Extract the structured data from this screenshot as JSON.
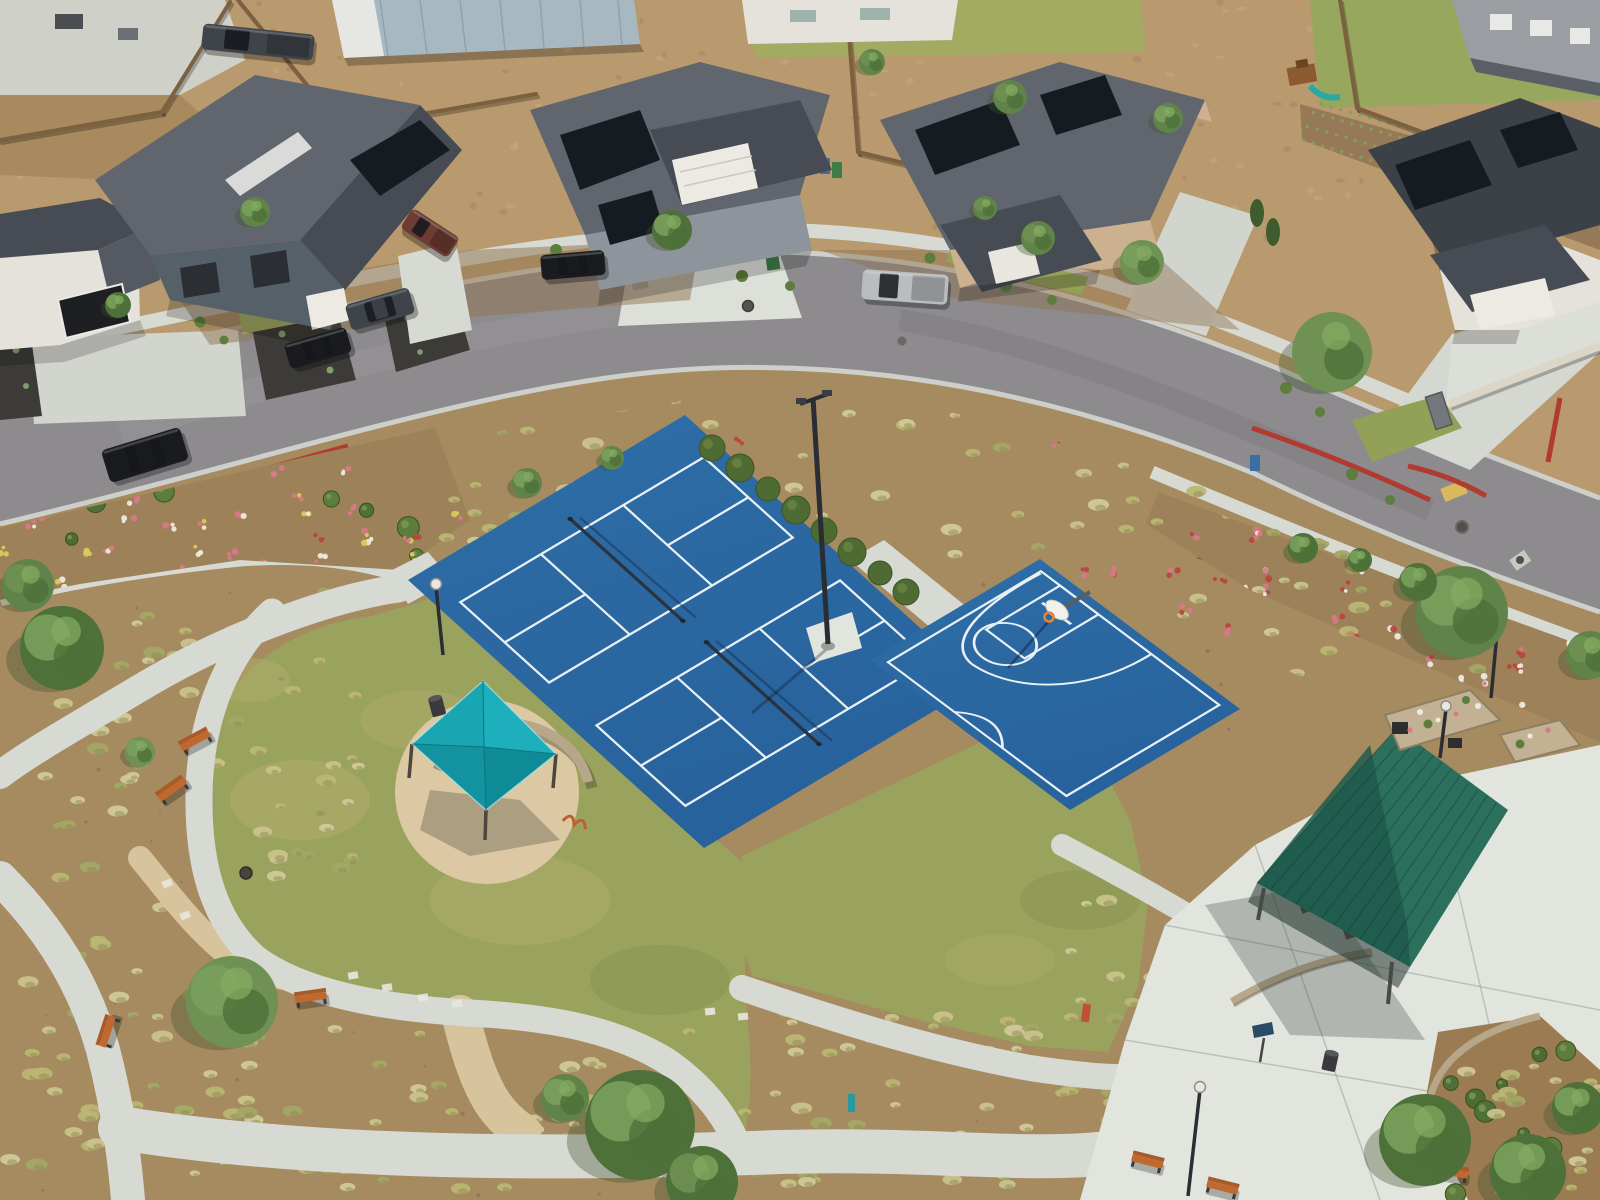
{
  "scene": {
    "title": "Aerial drone view of a community park with sport courts in a new residential neighborhood",
    "features": {
      "pickleball_courts": 2,
      "basketball_half_courts": 1,
      "shade_sail": "teal square canopy over seating area",
      "picnic_pavilion": "green metal gable roof",
      "benches": 7,
      "light_poles": 5,
      "vehicles": 7
    },
    "colors": {
      "court_blue": "#2e6da7",
      "court_blue_dark": "#27619b",
      "court_line": "#e9f1f5",
      "lawn": "#9aa35e",
      "lawn_light": "#b5b172",
      "lawn_dark": "#7e8c4a",
      "concrete": "#d7d9d3",
      "concrete_bright": "#e2e4de",
      "dg": "#d8c49c",
      "dg_circle": "#dcc9a4",
      "street": "#8d8b8e",
      "curb": "#cdd0ca",
      "red_curb": "#b23a30",
      "mulch": "#a68a60",
      "mulch_dark": "#8d7150",
      "bed_mulch": "#9d8158",
      "dirt": "#b89a6e",
      "dirt_light": "#c9ad80",
      "fence": "#7d6040",
      "wall_light": "#dbd6c7",
      "stone": "#b7a78a",
      "canopy_ne": "#1db0bc",
      "canopy_se": "#0f8b97",
      "canopy_sw": "#12939f",
      "canopy_nw": "#19a5b1",
      "pavilion_roof": "#2b6f5d",
      "pavilion_roof_dark": "#1e5a4b",
      "roof_gray": "#61666e",
      "roof_dark": "#474c54",
      "roof_darker": "#3c4148",
      "solar": "#161b22",
      "white_wall": "#e4e2da",
      "tan_wall": "#cbb18f",
      "gray_wall": "#566069",
      "trim": "#eceae2",
      "tree1": "#5f8348",
      "tree2": "#4d7139",
      "tree3": "#6f9153",
      "shrub": "#4e6b33",
      "tuftA": "#bab674",
      "tuftB": "#c9c38a",
      "tuftC": "#a3a865",
      "tuftD": "#d0c998",
      "bench_seat": "#c0692f",
      "bench_back": "#a85a28",
      "bench_frame": "#333a42",
      "black_car": "#1a1b1e",
      "gray_car": "#3f444b",
      "silver_car": "#b9bdc0",
      "maroon_car": "#6e3c34",
      "hoop_orange": "#e8842f",
      "teal_fountain": "#2b9aa0",
      "red_fountain": "#c05038",
      "sign_blue": "#2b4a66",
      "yellow_ada": "#d9b95c",
      "black_mulch": "#3c3b38",
      "agave": "#7fa06a",
      "flower_pink": "#d9788a",
      "flower_red": "#b8473d",
      "flower_white": "#ece9df",
      "flower_yellow": "#d9c95e",
      "barn_roof": "#a7b8c1"
    },
    "trees": [
      [
        62,
        648,
        42
      ],
      [
        28,
        585,
        26
      ],
      [
        140,
        752,
        15
      ],
      [
        232,
        1002,
        46
      ],
      [
        640,
        1125,
        55
      ],
      [
        702,
        1182,
        36
      ],
      [
        565,
        1098,
        24
      ],
      [
        1425,
        1140,
        46
      ],
      [
        1528,
        1172,
        38
      ],
      [
        1578,
        1108,
        26
      ],
      [
        1462,
        612,
        46
      ],
      [
        1332,
        352,
        40
      ],
      [
        1590,
        655,
        24
      ],
      [
        672,
        230,
        20
      ],
      [
        1142,
        262,
        22
      ],
      [
        1038,
        238,
        17
      ],
      [
        527,
        483,
        15
      ],
      [
        612,
        458,
        12
      ],
      [
        1303,
        548,
        15
      ],
      [
        1418,
        582,
        19
      ],
      [
        1010,
        97,
        17
      ],
      [
        1168,
        118,
        15
      ],
      [
        872,
        62,
        13
      ],
      [
        255,
        212,
        15
      ],
      [
        118,
        305,
        13
      ],
      [
        985,
        208,
        12
      ],
      [
        1360,
        560,
        12
      ]
    ],
    "benches": [
      [
        196,
        742,
        -28
      ],
      [
        173,
        791,
        -35
      ],
      [
        311,
        999,
        -8
      ],
      [
        109,
        1032,
        -72
      ],
      [
        1147,
        1163,
        14
      ],
      [
        1222,
        1189,
        14
      ],
      [
        1452,
        1174,
        10
      ]
    ],
    "vehicles": [
      {
        "name": "black-suv",
        "x": 145,
        "y": 455,
        "w": 82,
        "h": 34,
        "angle": -17,
        "color": "black_car",
        "truck": false
      },
      {
        "name": "black-sedan",
        "x": 318,
        "y": 348,
        "w": 64,
        "h": 26,
        "angle": -16,
        "color": "black_car",
        "truck": false
      },
      {
        "name": "gray-suv",
        "x": 380,
        "y": 309,
        "w": 66,
        "h": 27,
        "angle": -16,
        "color": "gray_car",
        "truck": false
      },
      {
        "name": "black-sedan-2",
        "x": 573,
        "y": 265,
        "w": 64,
        "h": 25,
        "angle": -5,
        "color": "black_car",
        "truck": false
      },
      {
        "name": "silver-pickup",
        "x": 905,
        "y": 287,
        "w": 86,
        "h": 30,
        "angle": 4,
        "color": "silver_car",
        "truck": true
      },
      {
        "name": "maroon-pickup",
        "x": 430,
        "y": 233,
        "w": 56,
        "h": 24,
        "angle": 33,
        "color": "maroon_car",
        "truck": true
      },
      {
        "name": "work-truck",
        "x": 258,
        "y": 42,
        "w": 112,
        "h": 26,
        "angle": 6,
        "color": "gray_car",
        "truck": true
      }
    ],
    "scatter": [
      {
        "id": "dirt-top",
        "kind": "dirt",
        "bounds": [
          0,
          0,
          1600,
          240
        ],
        "count": 150
      },
      {
        "id": "park-dots",
        "kind": "mulchdots",
        "bounds": [
          0,
          560,
          1240,
          640
        ],
        "count": 90
      },
      {
        "id": "buffer",
        "kind": "tuft",
        "bounds": [
          260,
          400,
          1180,
          300
        ],
        "count": 120,
        "clip": "clipBuffer"
      },
      {
        "id": "buffer-fl",
        "kind": "flowers",
        "colors": [
          "flower_red",
          "flower_pink"
        ],
        "bounds": [
          300,
          430,
          1000,
          240
        ],
        "count": 26,
        "clip": "clipBuffer"
      },
      {
        "id": "bed-left",
        "kind": "flowers",
        "colors": [
          "flower_white",
          "flower_pink",
          "flower_yellow"
        ],
        "bounds": [
          0,
          470,
          460,
          120
        ],
        "count": 34,
        "clip": "clipBedLeft"
      },
      {
        "id": "bed-left-sh",
        "kind": "shrubs",
        "bounds": [
          0,
          470,
          460,
          120
        ],
        "count": 12,
        "clip": "clipBedLeft"
      },
      {
        "id": "bench-area",
        "kind": "tuft",
        "bounds": [
          40,
          610,
          320,
          270
        ],
        "count": 60
      },
      {
        "id": "sw-corner",
        "kind": "tuft",
        "bounds": [
          10,
          890,
          250,
          300
        ],
        "count": 55
      },
      {
        "id": "south-band",
        "kind": "tuft",
        "bounds": [
          240,
          1010,
          840,
          180
        ],
        "count": 110
      },
      {
        "id": "east-mulch",
        "kind": "tuft",
        "bounds": [
          1060,
          900,
          320,
          230
        ],
        "count": 48
      },
      {
        "id": "right-bed",
        "kind": "flowers",
        "colors": [
          "flower_pink",
          "flower_red",
          "flower_white"
        ],
        "bounds": [
          1180,
          500,
          420,
          250
        ],
        "count": 46,
        "clip": "clipBedRight"
      },
      {
        "id": "right-bed-t",
        "kind": "tuft",
        "bounds": [
          1180,
          500,
          420,
          250
        ],
        "count": 22,
        "clip": "clipBedRight"
      },
      {
        "id": "se-bed-sh",
        "kind": "shrubs",
        "bounds": [
          1440,
          1040,
          160,
          160
        ],
        "count": 10
      },
      {
        "id": "se-bed-t",
        "kind": "tuft",
        "bounds": [
          1430,
          1040,
          170,
          160
        ],
        "count": 22
      }
    ]
  }
}
